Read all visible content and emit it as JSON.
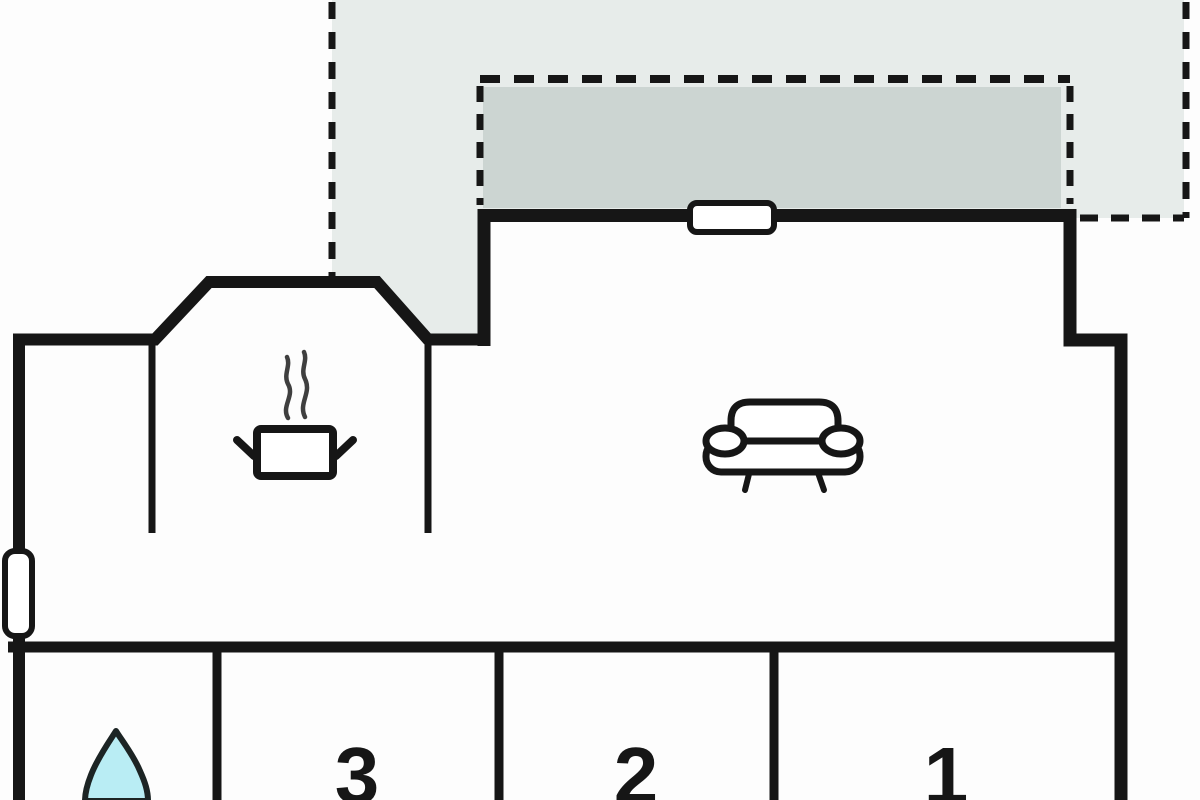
{
  "plan": {
    "type": "floor-plan",
    "room_labels": {
      "r3": "3",
      "r2": "2",
      "r1": "1"
    },
    "icons": [
      "steam-pot-icon",
      "sofa-icon",
      "water-drop-icon",
      "window-marker-top",
      "window-marker-left"
    ],
    "areas": [
      "terrace-open-area",
      "terrace-covered-area",
      "kitchen-area",
      "living-area",
      "bathroom",
      "bedroom-3",
      "bedroom-2",
      "bedroom-1"
    ],
    "colors": {
      "wall": "#161616",
      "terrace_light": "#e7ecea",
      "terrace_dark": "#ccd5d2",
      "background": "#fdfdfd",
      "room_fill": "#ffffff",
      "water_drop": "#b9edf4",
      "steam": "#3f3f3f"
    }
  }
}
